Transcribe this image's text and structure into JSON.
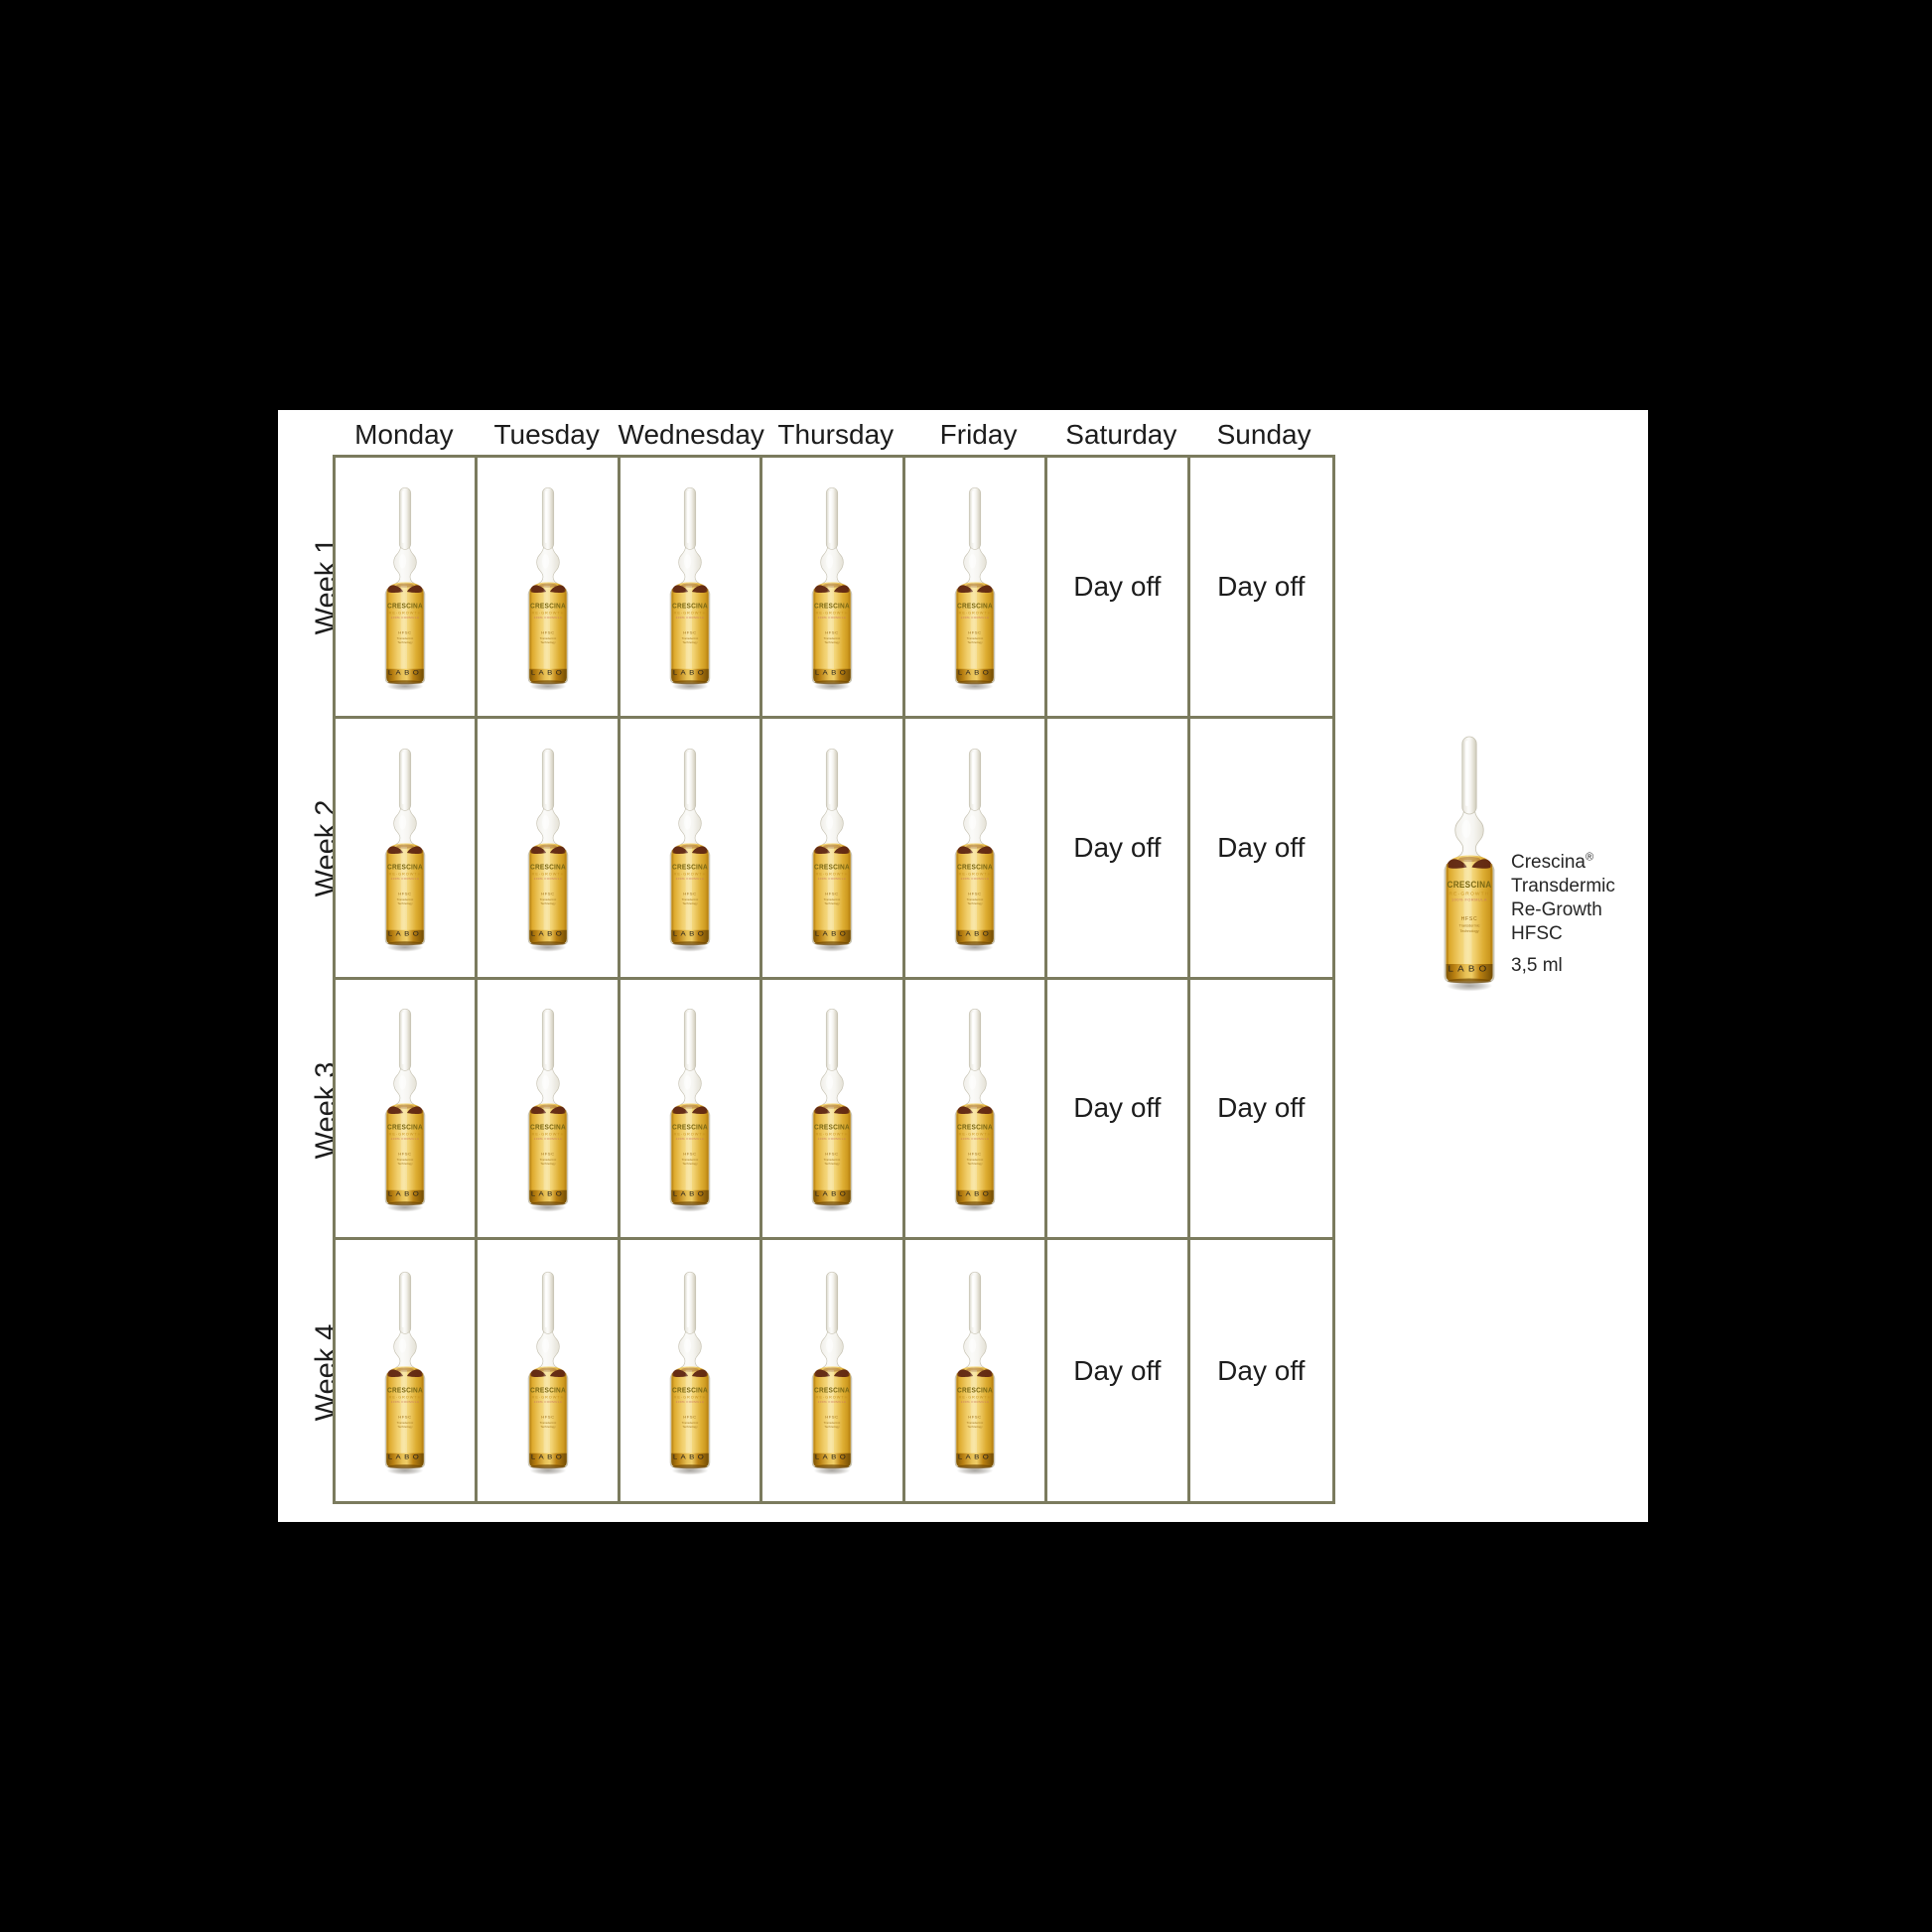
{
  "page": {
    "background": "#000000",
    "card_background": "#ffffff"
  },
  "calendar": {
    "grid_line_color": "#7b7b5e",
    "text_color": "#1c1c1c",
    "day_headers": [
      "Monday",
      "Tuesday",
      "Wednesday",
      "Thursday",
      "Friday",
      "Saturday",
      "Sunday"
    ],
    "day_off_label": "Day off",
    "schedule": [
      {
        "week": "Week 1",
        "days": [
          "ampoule",
          "ampoule",
          "ampoule",
          "ampoule",
          "ampoule",
          "day_off",
          "day_off"
        ]
      },
      {
        "week": "Week 2",
        "days": [
          "ampoule",
          "ampoule",
          "ampoule",
          "ampoule",
          "ampoule",
          "day_off",
          "day_off"
        ]
      },
      {
        "week": "Week 3",
        "days": [
          "ampoule",
          "ampoule",
          "ampoule",
          "ampoule",
          "ampoule",
          "day_off",
          "day_off"
        ]
      },
      {
        "week": "Week 4",
        "days": [
          "ampoule",
          "ampoule",
          "ampoule",
          "ampoule",
          "ampoule",
          "day_off",
          "day_off"
        ]
      }
    ]
  },
  "legend": {
    "product_name": "Crescina",
    "registered_mark": "®",
    "product_lines": [
      "Transdermic",
      "Re-Growth",
      "HFSC"
    ],
    "volume": "3,5 ml"
  },
  "ampoule_label": {
    "brand": "CRESCINA",
    "range": "RE-GROWTH",
    "formula": "100% FORMULA",
    "tech_line_1": "HFSC",
    "tech_line_2": "Transdermic",
    "tech_line_3": "Technology",
    "maker": "LABO",
    "colors": {
      "liquid_center": "#f7e191",
      "liquid_edge": "#cf9a1d",
      "base_amber": "#7c5203",
      "meniscus_blob": "#5a2110",
      "glass": "#fbfbf9"
    }
  }
}
